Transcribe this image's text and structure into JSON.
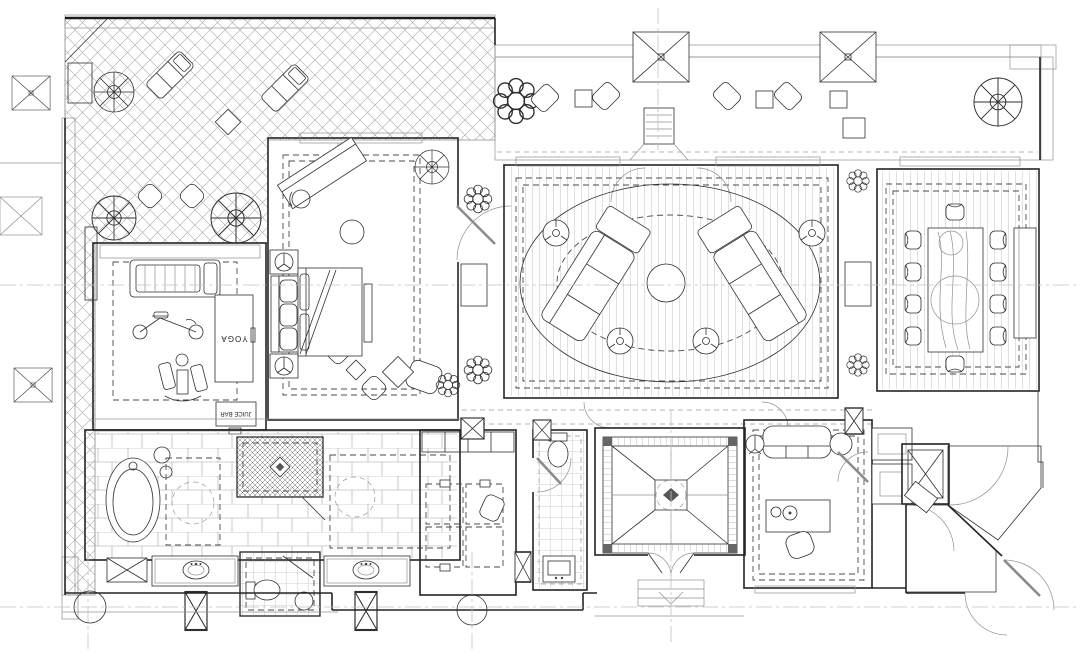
{
  "labels": {
    "yoga": "YOGA",
    "juice_bar": "JUICE BAR"
  },
  "palette": {
    "background": "#ffffff",
    "ink": "#2f2f2f",
    "ink_light": "#8f8f8f",
    "centerline": "#c2c2c2",
    "accent_dark": "#4c4c4c"
  }
}
